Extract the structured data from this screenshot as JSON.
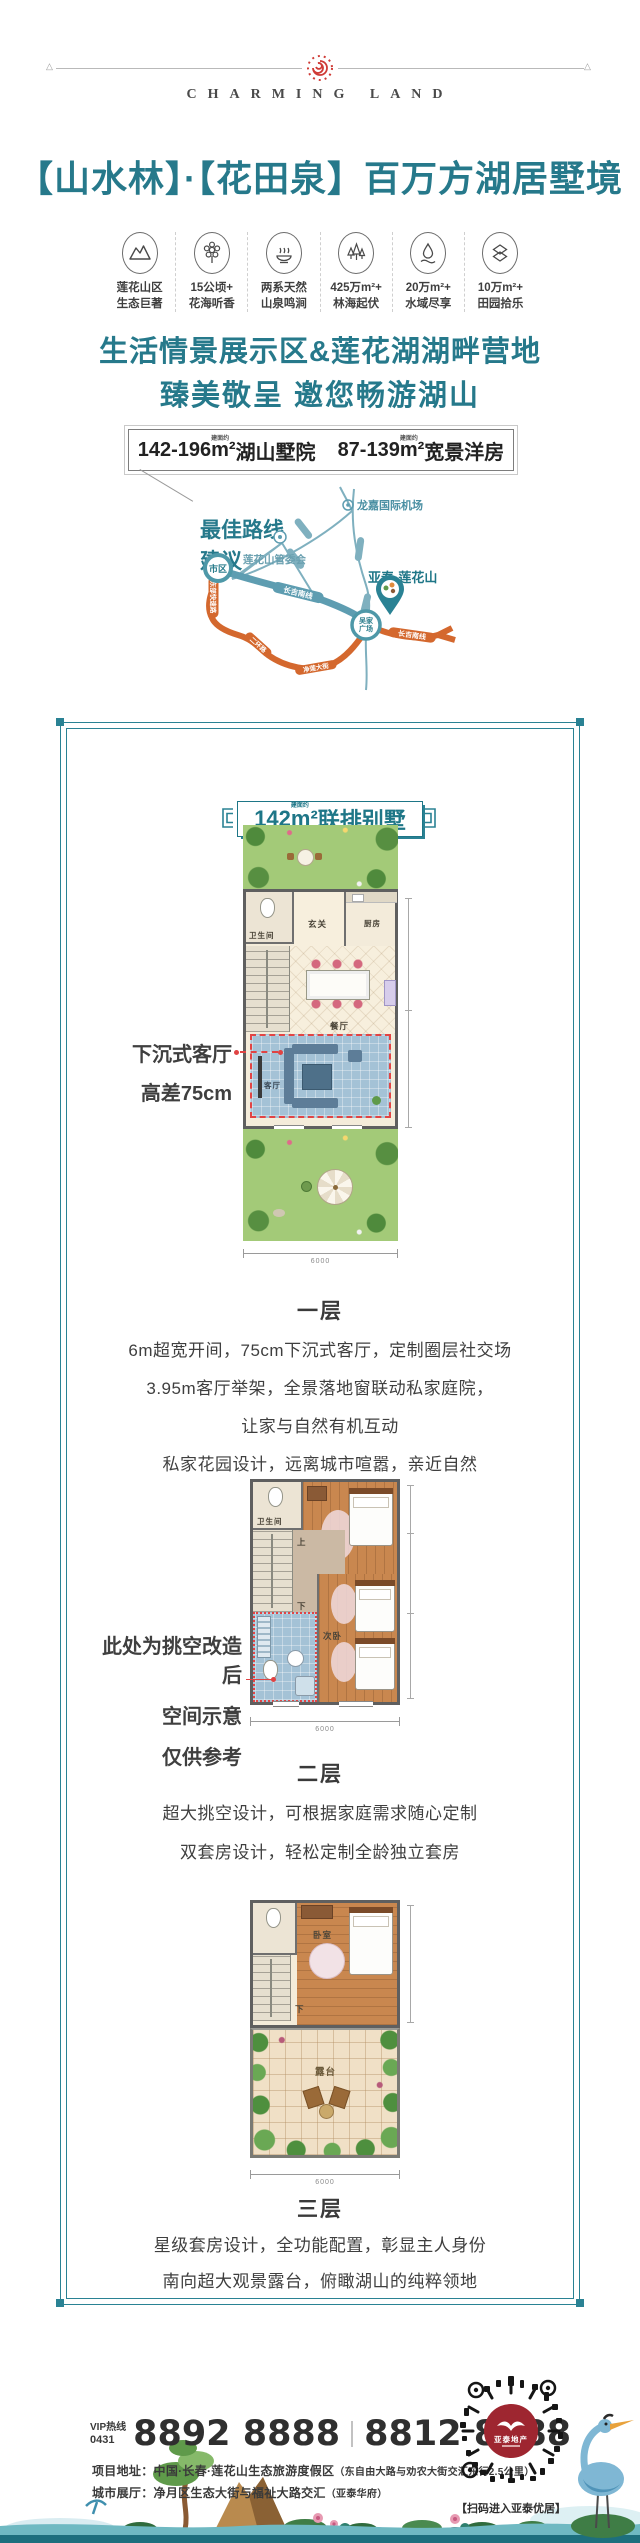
{
  "header": {
    "brand": "CHARMING LAND",
    "title": "【山水林】·【花田泉】百万方湖居墅境"
  },
  "features": [
    {
      "icon": "mountain-icon",
      "line1": "莲花山区",
      "line2": "生态巨著"
    },
    {
      "icon": "flower-icon",
      "line1": "15公顷+",
      "line2": "花海听香"
    },
    {
      "icon": "hot-spring-icon",
      "line1": "两系天然",
      "line2": "山泉鸣涧"
    },
    {
      "icon": "forest-icon",
      "line1": "425万m²+",
      "line2": "林海起伏"
    },
    {
      "icon": "water-icon",
      "line1": "20万m²+",
      "line2": "水域尽享"
    },
    {
      "icon": "field-icon",
      "line1": "10万m²+",
      "line2": "田园拾乐"
    }
  ],
  "intro": {
    "line1": "生活情景展示区&莲花湖湖畔营地",
    "line2": "臻美敬呈 邀您畅游湖山"
  },
  "area_box": {
    "note": "建面约",
    "left_range": "142-196",
    "left_unit": "m²",
    "left_name": "湖山墅院",
    "right_range": "87-139",
    "right_unit": "m²",
    "right_name": "宽景洋房"
  },
  "map": {
    "title_line1": "最佳路线",
    "title_line2": "建议",
    "airport": "龙嘉国际机场",
    "committee": "莲花山管委会",
    "city": "市区",
    "square_line1": "吴家",
    "square_line2": "广场",
    "project": "亚泰·莲花山",
    "road_changji_south_1": "长吉南线",
    "road_changji_south_2": "长吉南线",
    "road_east_expressway": "东部快速路",
    "road_ring": "二环路",
    "road_jinglian": "净莲大街"
  },
  "badge": {
    "note": "建面约",
    "number": "142",
    "unit": "m²",
    "name": "联排别墅"
  },
  "floors": [
    {
      "caption": "一层",
      "rooms": {
        "bath": "卫生间",
        "foyer": "玄关",
        "kitchen": "厨房",
        "dining": "餐厅",
        "living": "客厅",
        "up": "上",
        "down": "下"
      },
      "annotation": {
        "line1": "下沉式客厅",
        "line2": "高差75cm"
      },
      "dim_bottom": "6000",
      "desc": [
        "6m超宽开间，75cm下沉式客厅，定制圈层社交场",
        "3.95m客厅举架，全景落地窗联动私家庭院，",
        "让家与自然有机互动",
        "私家花园设计，远离城市喧嚣，亲近自然"
      ]
    },
    {
      "caption": "二层",
      "rooms": {
        "bath": "卫生间",
        "bedroom2": "次卧",
        "up": "上",
        "down": "下"
      },
      "annotation": {
        "line1": "此处为挑空改造后",
        "line2": "空间示意",
        "line3": "仅供参考"
      },
      "dim_bottom": "6000",
      "desc": [
        "超大挑空设计，可根据家庭需求随心定制",
        "双套房设计，轻松定制全龄独立套房"
      ]
    },
    {
      "caption": "三层",
      "rooms": {
        "bedroom": "卧室",
        "terrace": "露台",
        "down": "下"
      },
      "dim_bottom": "6000",
      "desc": [
        "星级套房设计，全功能配置，彰显主人身份",
        "南向超大观景露台，俯瞰湖山的纯粹领地"
      ]
    }
  ],
  "footer": {
    "vip_label": "VIP热线",
    "area_code": "0431",
    "phone1": "8892 8888",
    "phone2": "8812 8888",
    "addr1_label": "项目地址：",
    "addr1": "中国·长春·莲花山生态旅游度假区",
    "addr1_note": "（东自由大路与劝农大街交汇东行2.5公里）",
    "addr2_label": "城市展厅：",
    "addr2": "净月区生态大街与福祉大路交汇",
    "addr2_note": "（亚泰华府）",
    "qr_logo": "亚泰地产",
    "qr_caption": "【扫码进入亚泰优居】"
  }
}
